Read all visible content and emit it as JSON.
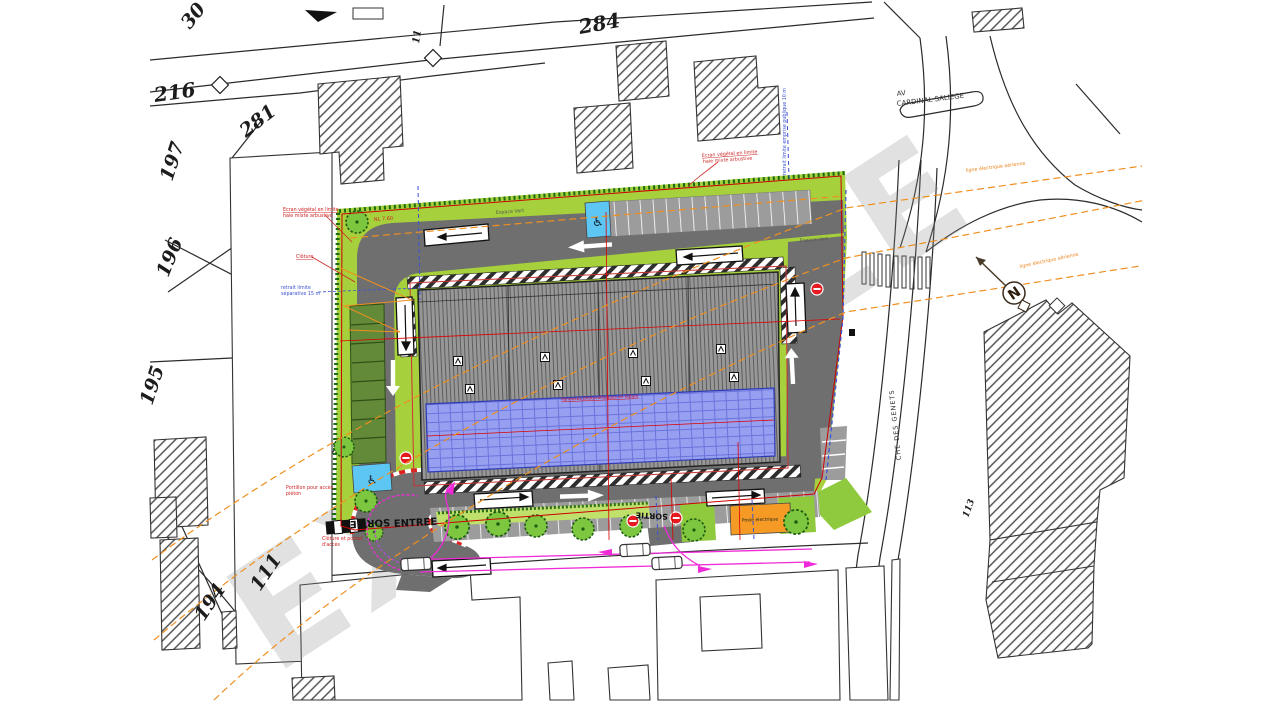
{
  "plan": {
    "watermark": "EXEMPLE",
    "compass_n": "N"
  },
  "parcels": {
    "p30": "30",
    "p216": "216",
    "p281": "281",
    "p284": "284",
    "p197": "197",
    "p196": "196",
    "p195": "195",
    "p194": "194",
    "p111": "111",
    "p113": "113",
    "p11": "11"
  },
  "streets": {
    "avenue_line1": "AV",
    "avenue_line2": "CARDINAL SALIEGE",
    "chemin": "CHE DES GENETS"
  },
  "labels": {
    "espace_vert": "Espace Vert",
    "entree": "ENTREE",
    "sortie": "SORTIE",
    "panneaux": "Panneaux photovoltaïques en toiture",
    "poste": "Poste electrique",
    "niveau": "NL 7.60"
  },
  "annotations": {
    "ecran_line1": "Ecran végétal en limite",
    "ecran_line2": "haie mixte arbustive",
    "cloture": "Clôture",
    "retrait_sep_line1": "retrait limite",
    "retrait_sep_line2": "séparative 15 m",
    "retrait_emprise": "retrait limite emprise publique 10 m",
    "portillon_line1": "Portillon pour accès",
    "portillon_line2": "piéton",
    "cloture_portail_line1": "Clôture et portail",
    "cloture_portail_line2": "d'accès",
    "ligne_hta": "ligne électrique aérienne"
  },
  "icons": {
    "wheelchair": "♿"
  }
}
